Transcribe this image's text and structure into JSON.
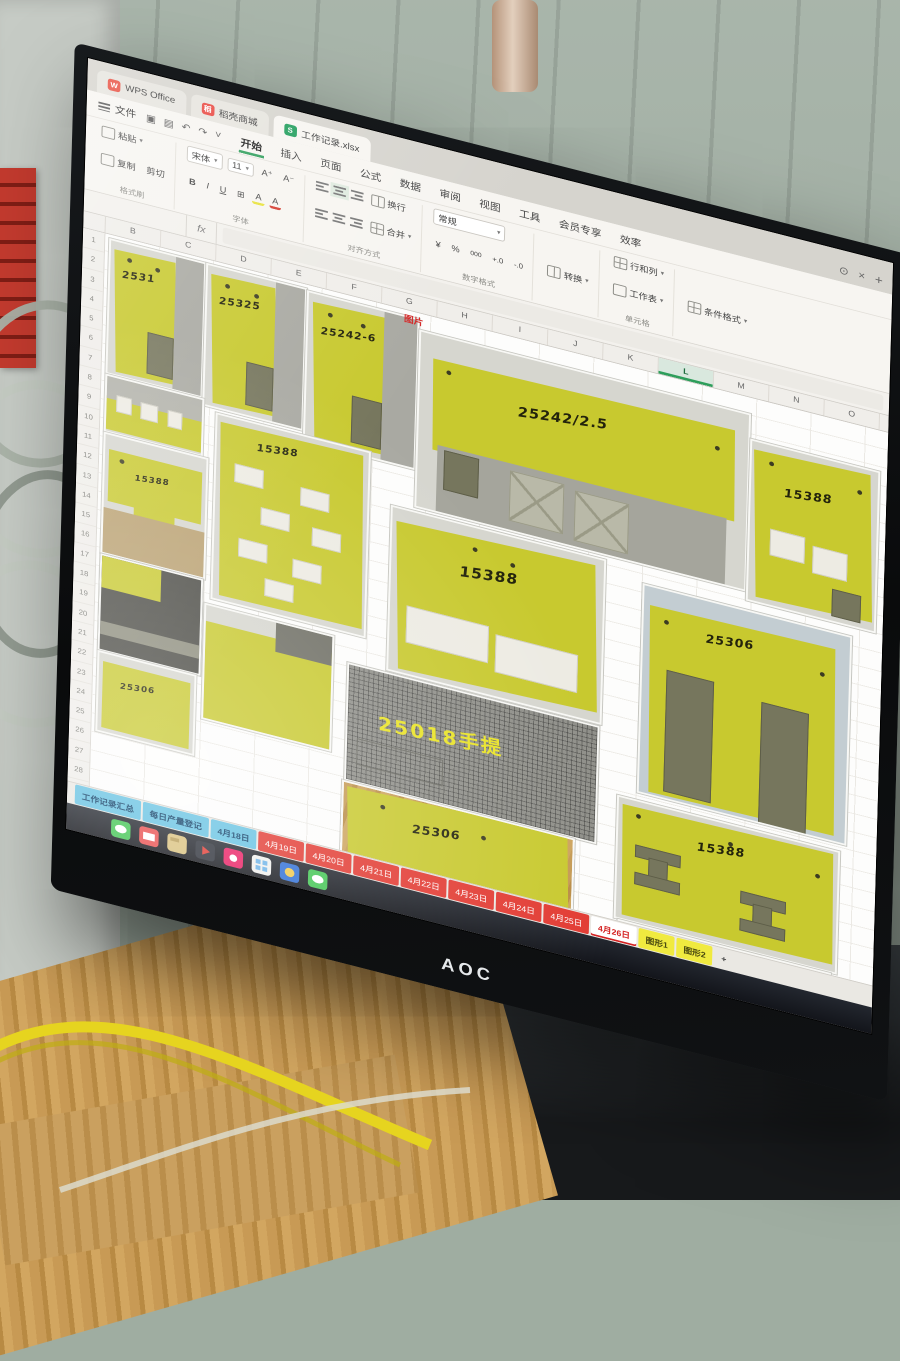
{
  "colors": {
    "wps_green": "#2e9e5b",
    "doc_tab_red": "#e84c3d",
    "sheet_icon_green": "#1f9d5b",
    "sheet_tab_red": "#e23b33",
    "sheet_tab_blue": "#66c2e2",
    "sheet_tab_yellow": "#f0ea3f",
    "panel_yellow": "#c8c92f",
    "mesh_label_yellow": "#e9e326",
    "selected_green": "#2e9e5b"
  },
  "window_tabs": {
    "tabs": [
      {
        "label": "WPS Office",
        "icon": "wps-icon",
        "glyph": "W",
        "active": false
      },
      {
        "label": "稻壳商城",
        "icon": "docer-icon",
        "glyph": "稻",
        "active": false
      },
      {
        "label": "工作记录.xlsx",
        "icon": "sheet-icon",
        "glyph": "S",
        "active": true
      }
    ],
    "actions": {
      "sync": "⊙",
      "close": "×",
      "new_tab": "+"
    }
  },
  "menubar": {
    "file": "文件",
    "quick_icons": [
      "▣",
      "▤",
      "↶",
      "↷",
      "˅"
    ],
    "ribbon_tabs": [
      {
        "label": "开始",
        "active": true
      },
      {
        "label": "插入",
        "active": false
      },
      {
        "label": "页面",
        "active": false
      },
      {
        "label": "公式",
        "active": false
      },
      {
        "label": "数据",
        "active": false
      },
      {
        "label": "审阅",
        "active": false
      },
      {
        "label": "视图",
        "active": false
      },
      {
        "label": "工具",
        "active": false
      },
      {
        "label": "会员专享",
        "active": false
      },
      {
        "label": "效率",
        "active": false
      }
    ]
  },
  "ribbon": {
    "paste": "粘贴",
    "copy": "复制",
    "cut": "剪切",
    "format_painter": "格式刷",
    "font_name": "宋体",
    "font_size": "11",
    "grow": "A⁺",
    "shrink": "A⁻",
    "bold": "B",
    "italic": "I",
    "underline": "U",
    "strike": "A",
    "borders": "⊞",
    "highlight": "A",
    "fontcolor": "A",
    "font_group": "字体",
    "wrap": "换行",
    "merge": "合并",
    "align_group": "对齐方式",
    "number_format": "常规",
    "currency": "¥",
    "percent": "%",
    "thousands": "000",
    "dec_add": "+.0",
    "dec_sub": "-.0",
    "number_group": "数字格式",
    "convert": "转换",
    "rows_cols": "行和列",
    "worksheet": "工作表",
    "cells_group": "单元格",
    "conditional": "条件格式"
  },
  "formula_bar": {
    "name_box": "",
    "fx": "fx"
  },
  "grid": {
    "columns": [
      "B",
      "C",
      "D",
      "E",
      "F",
      "G",
      "H",
      "I",
      "J",
      "K",
      "L",
      "M",
      "N",
      "O"
    ],
    "selected_column": "L",
    "row_numbers": [
      "1",
      "2",
      "3",
      "4",
      "5",
      "6",
      "7",
      "8",
      "9",
      "10",
      "11",
      "12",
      "13",
      "14",
      "15",
      "16",
      "17",
      "18",
      "19",
      "20",
      "21",
      "22",
      "23",
      "24",
      "25",
      "26",
      "27",
      "28",
      "29",
      "30"
    ],
    "photo_header": "图片"
  },
  "photos": [
    {
      "id": "p1",
      "type": "tall",
      "label": "2531",
      "x": 4,
      "y": 4,
      "w": 96,
      "h": 150
    },
    {
      "id": "p2",
      "type": "tall",
      "label": "25325",
      "x": 104,
      "y": 4,
      "w": 100,
      "h": 158
    },
    {
      "id": "p3",
      "type": "tall",
      "label": "25242-6",
      "x": 208,
      "y": 6,
      "w": 112,
      "h": 168
    },
    {
      "id": "p4",
      "type": "wide",
      "label": "25242/2.5",
      "x": 324,
      "y": 18,
      "w": 338,
      "h": 198
    },
    {
      "id": "p5",
      "type": "slots",
      "label": "15388",
      "x": 666,
      "y": 46,
      "w": 130,
      "h": 180
    },
    {
      "id": "p6",
      "type": "strip",
      "label": "",
      "x": 4,
      "y": 158,
      "w": 98,
      "h": 62
    },
    {
      "id": "p7",
      "type": "tpanel",
      "label": "15388",
      "x": 4,
      "y": 224,
      "w": 104,
      "h": 134
    },
    {
      "id": "p8",
      "type": "stencil",
      "label": "15388",
      "x": 118,
      "y": 170,
      "w": 156,
      "h": 208
    },
    {
      "id": "p9",
      "type": "bigslot",
      "label": "15388",
      "x": 300,
      "y": 224,
      "w": 218,
      "h": 184
    },
    {
      "id": "p10",
      "type": "doors",
      "label": "25306",
      "x": 560,
      "y": 240,
      "w": 212,
      "h": 234
    },
    {
      "id": "p11",
      "type": "darkphoto",
      "label": "",
      "x": 4,
      "y": 362,
      "w": 102,
      "h": 106
    },
    {
      "id": "p12",
      "type": "small",
      "label": "25306",
      "x": 4,
      "y": 472,
      "w": 98,
      "h": 88
    },
    {
      "id": "p13",
      "type": "plainpanel",
      "label": "",
      "x": 112,
      "y": 388,
      "w": 130,
      "h": 128
    },
    {
      "id": "p14",
      "type": "mesh",
      "label": "25018手提",
      "x": 260,
      "y": 414,
      "w": 256,
      "h": 130
    },
    {
      "id": "p15",
      "type": "wood",
      "label": "25306",
      "x": 258,
      "y": 548,
      "w": 236,
      "h": 150
    },
    {
      "id": "p16",
      "type": "ibeam",
      "label": "15388",
      "x": 540,
      "y": 486,
      "w": 226,
      "h": 136
    },
    {
      "id": "p17",
      "type": "tabs",
      "label": "25306",
      "x": 544,
      "y": 626,
      "w": 216,
      "h": 110
    }
  ],
  "sheet_tabs": {
    "blue": [
      "工作记录汇总",
      "每日产量登记",
      "4月18日"
    ],
    "red": [
      "4月19日",
      "4月20日",
      "4月21日",
      "4月22日",
      "4月23日",
      "4月24日",
      "4月25日"
    ],
    "active": "4月26日",
    "yellow": [
      "图形1",
      "图形2"
    ],
    "add": "+"
  },
  "taskbar": {
    "icons": [
      {
        "name": "wechat-icon",
        "color": "#43c654",
        "glyph": "bubble"
      },
      {
        "name": "mail-icon",
        "color": "#e94f4f",
        "glyph": "mail"
      },
      {
        "name": "folder-icon",
        "color": "#d9c17e",
        "glyph": "folder"
      },
      {
        "name": "video-player-icon",
        "color": "#2b2f38",
        "glyph": "play"
      },
      {
        "name": "photos-icon",
        "color": "#e91e63",
        "glyph": "dot"
      },
      {
        "name": "file-explorer-icon",
        "color": "#f0f0ee",
        "glyph": "win"
      },
      {
        "name": "browser-icon",
        "color": "#2f6fd6",
        "glyph": "globe"
      },
      {
        "name": "wechat-chat-icon",
        "color": "#43c654",
        "glyph": "bubble"
      }
    ]
  },
  "monitor": {
    "brand": "AOC"
  }
}
